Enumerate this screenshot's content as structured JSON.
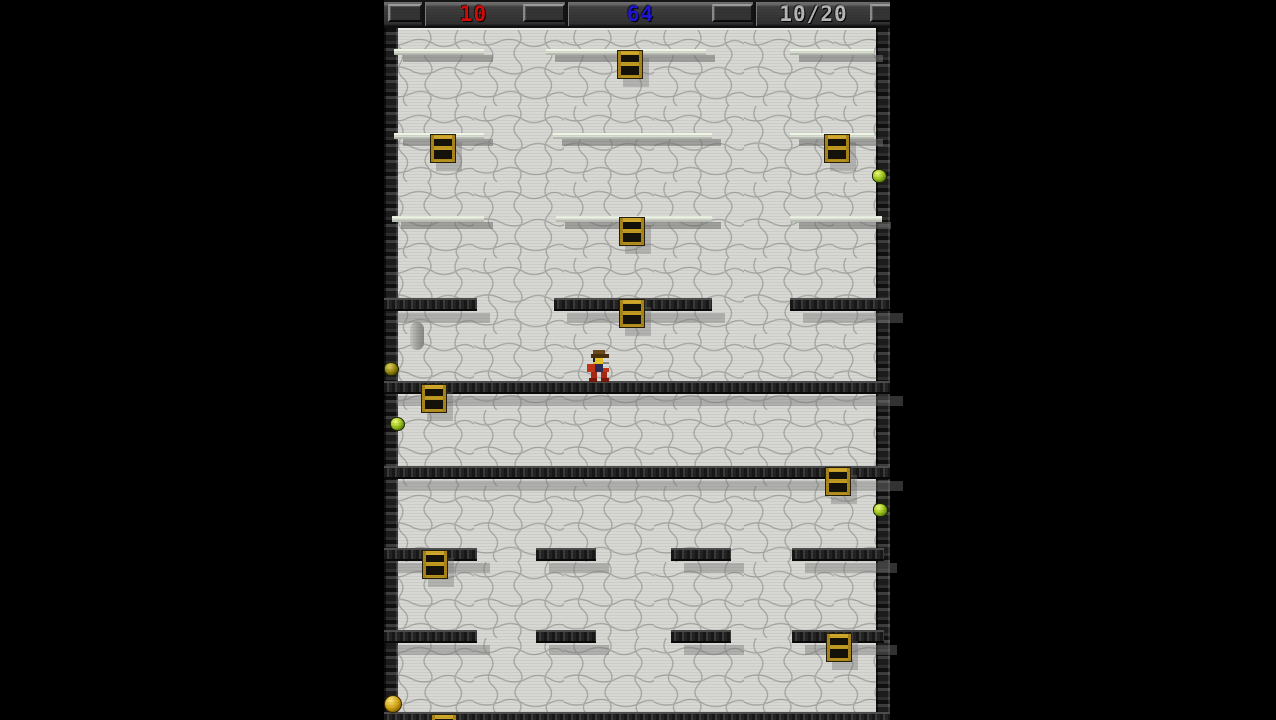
{
  "hud": {
    "score_red": "10",
    "score_blue": "64",
    "progress": "10/20",
    "red_color": "#d40a0a",
    "blue_color": "#2016d6",
    "gray_color": "#b6b6b6"
  },
  "level": {
    "thin_platforms": [
      [
        10,
        49,
        90
      ],
      [
        162,
        49,
        160
      ],
      [
        406,
        49,
        84
      ],
      [
        10,
        133,
        90
      ],
      [
        169,
        133,
        159
      ],
      [
        406,
        133,
        84
      ],
      [
        8,
        216,
        92
      ],
      [
        172,
        216,
        156
      ],
      [
        406,
        216,
        92
      ]
    ],
    "dark_platforms": [
      [
        0,
        298,
        93
      ],
      [
        170,
        298,
        158
      ],
      [
        406,
        298,
        100
      ],
      [
        0,
        381,
        506
      ],
      [
        0,
        466,
        506
      ],
      [
        0,
        548,
        93
      ],
      [
        152,
        548,
        60
      ],
      [
        287,
        548,
        60
      ],
      [
        408,
        548,
        92
      ],
      [
        0,
        630,
        93
      ],
      [
        152,
        630,
        60
      ],
      [
        287,
        630,
        60
      ],
      [
        408,
        630,
        92
      ],
      [
        0,
        712,
        506
      ]
    ],
    "ladders": [
      [
        233,
        50
      ],
      [
        46,
        134
      ],
      [
        440,
        134
      ],
      [
        235,
        217
      ],
      [
        235,
        299
      ],
      [
        37,
        384
      ],
      [
        441,
        467
      ],
      [
        38,
        550
      ],
      [
        442,
        633
      ],
      [
        47,
        714
      ]
    ],
    "gems": [
      [
        488,
        169,
        "green"
      ],
      [
        0,
        362,
        "olive"
      ],
      [
        6,
        417,
        "green"
      ],
      [
        489,
        503,
        "green"
      ],
      [
        0,
        695,
        "gold"
      ]
    ],
    "capsule": {
      "x": 26,
      "y": 322
    },
    "player": {
      "x": 198,
      "y": 350
    }
  }
}
